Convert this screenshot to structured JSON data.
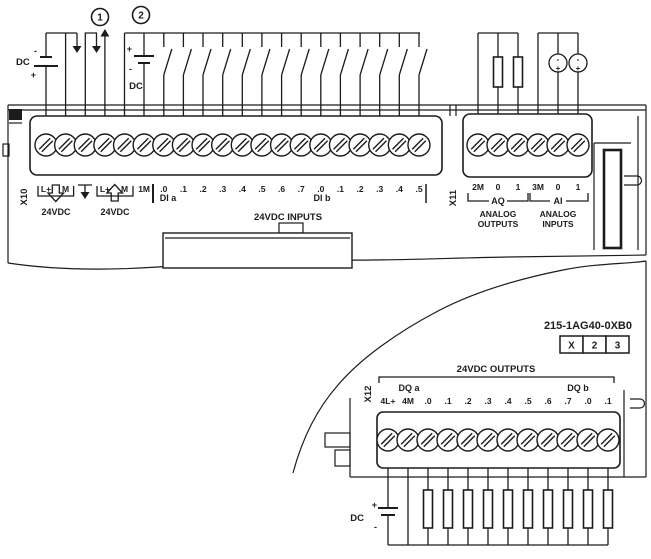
{
  "device": {
    "part_number": "215-1AG40-0XB0",
    "order_boxes": [
      "X",
      "2",
      "3"
    ]
  },
  "callouts": {
    "c1": "1",
    "c2": "2"
  },
  "supplies": {
    "cpu_power": {
      "name": "DC",
      "minus": "-",
      "plus": "+"
    },
    "input_power": {
      "name": "DC",
      "plus": "+",
      "minus": "-"
    },
    "output_power": {
      "name": "DC",
      "plus": "+",
      "minus": "-"
    }
  },
  "x10": {
    "connector": "X10",
    "terminals": [
      "L+",
      "M",
      "",
      "L+",
      "M",
      "1M",
      ".0",
      ".1",
      ".2",
      ".3",
      ".4",
      ".5",
      ".6",
      ".7",
      ".0",
      ".1",
      ".2",
      ".3",
      ".4",
      ".5"
    ],
    "supply_in_label": "24VDC",
    "sensor_out_label": "24VDC",
    "group_a": "DI a",
    "group_b": "DI b",
    "section_label": "24VDC INPUTS"
  },
  "x11": {
    "connector": "X11",
    "terminals": [
      "2M",
      "0",
      "1",
      "3M",
      "0",
      "1"
    ],
    "aq_label": "AQ",
    "ai_label": "AI",
    "aq_caption_1": "ANALOG",
    "aq_caption_2": "OUTPUTS",
    "ai_caption_1": "ANALOG",
    "ai_caption_2": "INPUTS"
  },
  "x12": {
    "connector": "X12",
    "terminals": [
      "4L+",
      "4M",
      ".0",
      ".1",
      ".2",
      ".3",
      ".4",
      ".5",
      ".6",
      ".7",
      ".0",
      ".1"
    ],
    "group_a": "DQ a",
    "group_b": "DQ b",
    "section_label": "24VDC OUTPUTS"
  },
  "analog_input_sources": {
    "minus": "-",
    "plus": "+"
  },
  "colors": {
    "line": "#1c1c1c",
    "background": "#ffffff"
  }
}
